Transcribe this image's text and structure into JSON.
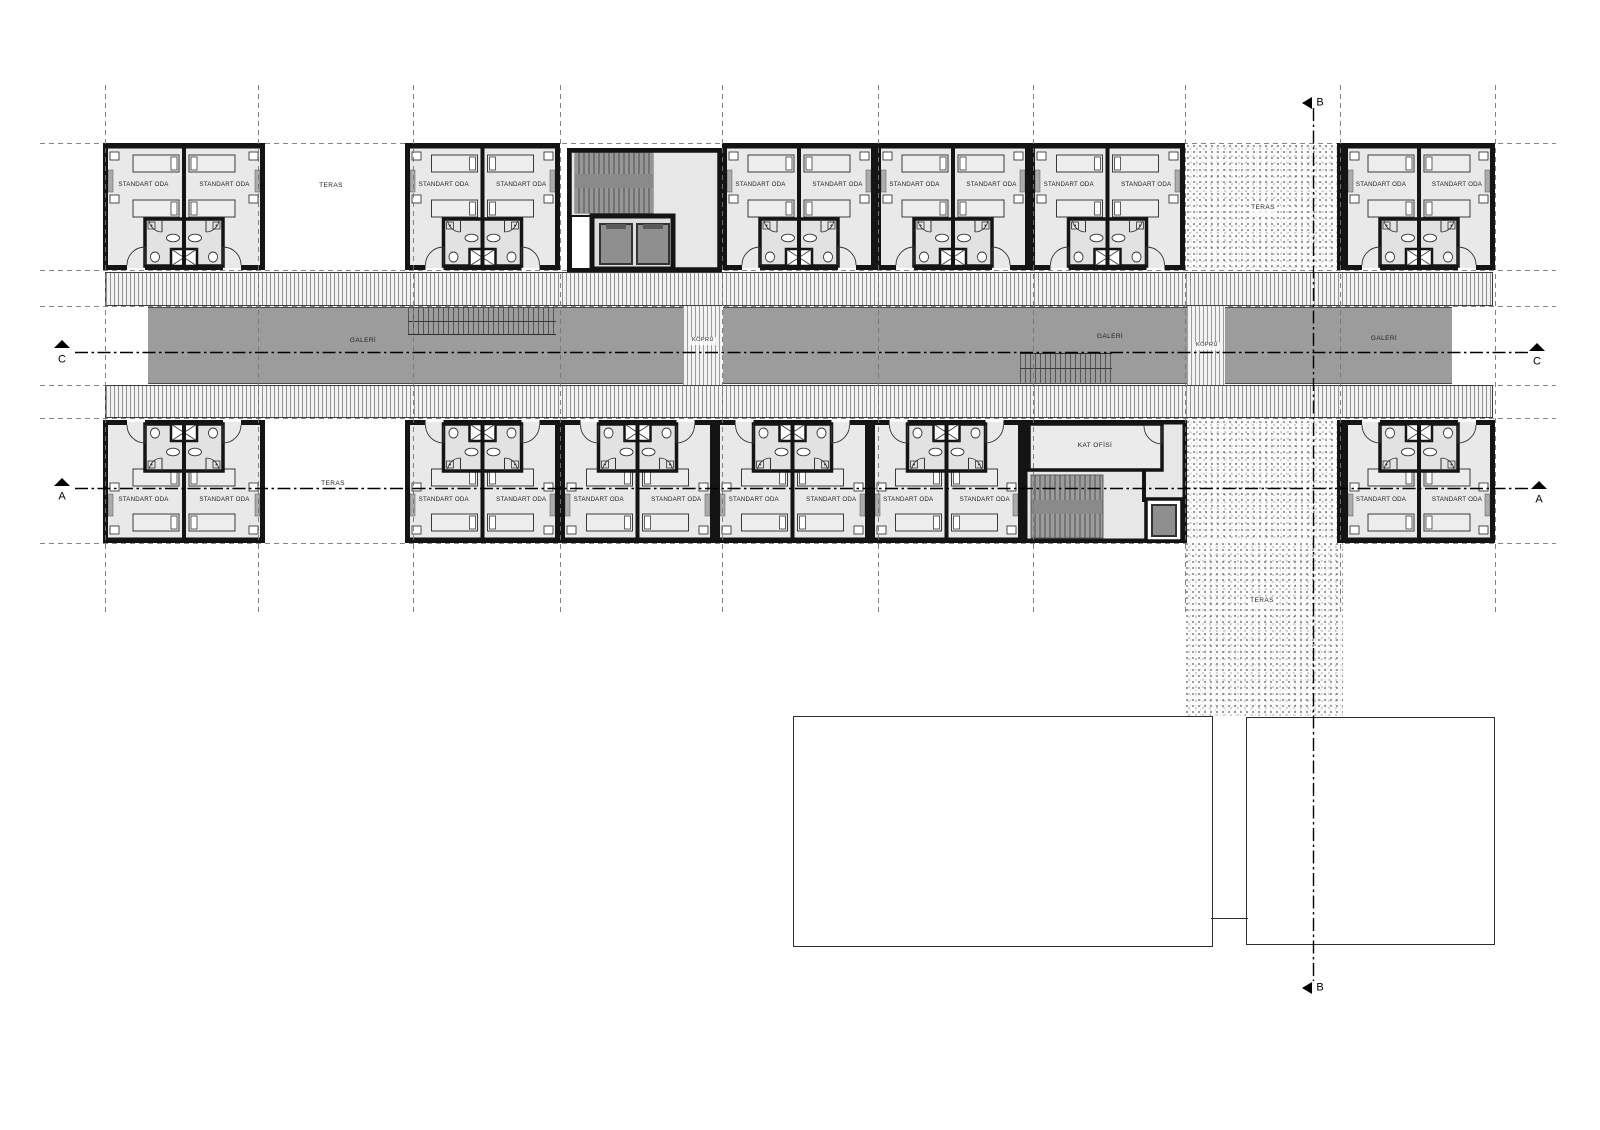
{
  "drawing": {
    "room_label": "STANDART ODA",
    "teras_label": "TERAS",
    "galeri_label": "GALERİ",
    "kopru_label": "KÖPRÜ",
    "kat_ofisi_label": "KAT OFİSİ",
    "section_a": "A",
    "section_b": "B",
    "section_c": "C",
    "room_count_top": 12,
    "room_count_bottom": 12,
    "colors": {
      "wall": "#141414",
      "room_fill": "#e9e9e9",
      "bath_fill": "#e2e2e2",
      "galeri_fill": "#9c9c9c",
      "stair_fill": "#8f8f8f",
      "core_fill": "#e7e7e7",
      "grid_line": "#777777",
      "section_line": "#000000"
    },
    "top_pairs": [
      {
        "x": 103,
        "w": 162
      },
      {
        "x": 405,
        "w": 155
      },
      {
        "x": 722,
        "w": 154
      },
      {
        "x": 876,
        "w": 154
      },
      {
        "x": 1030,
        "w": 155
      },
      {
        "x": 1343,
        "w": 152
      }
    ],
    "bottom_pairs": [
      {
        "x": 103,
        "w": 162
      },
      {
        "x": 405,
        "w": 155
      },
      {
        "x": 560,
        "w": 155
      },
      {
        "x": 715,
        "w": 155
      },
      {
        "x": 870,
        "w": 153
      },
      {
        "x": 1343,
        "w": 152
      }
    ],
    "grid_x": [
      105,
      258,
      413,
      560,
      722,
      878,
      1033,
      1185,
      1340,
      1495
    ]
  }
}
